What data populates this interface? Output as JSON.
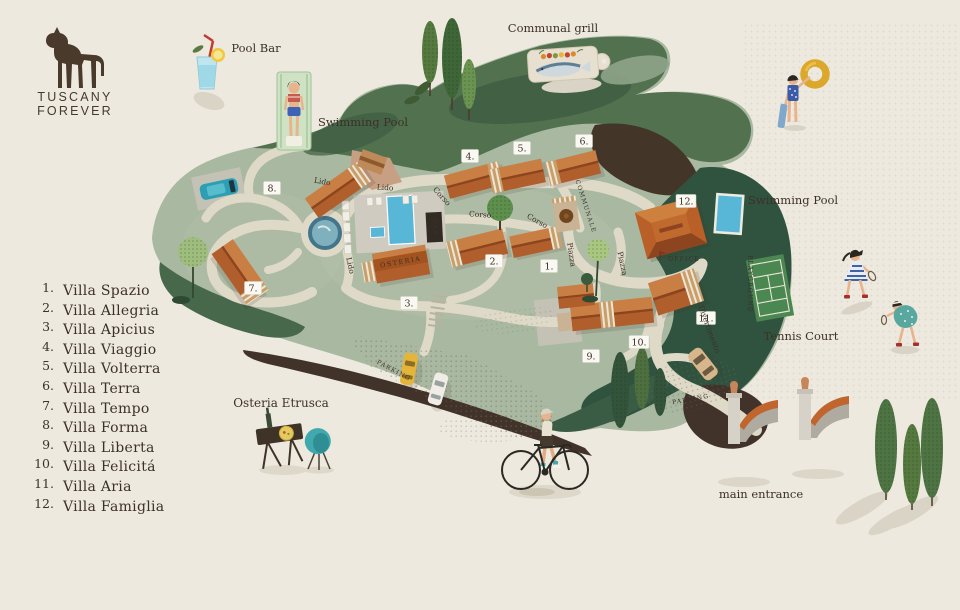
{
  "logo": {
    "line1": "TUSCANY",
    "line2": "FOREVER"
  },
  "legend": {
    "items": [
      {
        "num": "1.",
        "name": "Villa Spazio"
      },
      {
        "num": "2.",
        "name": "Villa Allegria"
      },
      {
        "num": "3.",
        "name": "Villa Apicius"
      },
      {
        "num": "4.",
        "name": "Villa Viaggio"
      },
      {
        "num": "5.",
        "name": "Villa Volterra"
      },
      {
        "num": "6.",
        "name": "Villa Terra"
      },
      {
        "num": "7.",
        "name": "Villa Tempo"
      },
      {
        "num": "8.",
        "name": "Villa Forma"
      },
      {
        "num": "9.",
        "name": "Villa Liberta"
      },
      {
        "num": "10.",
        "name": "Villa Felicitá"
      },
      {
        "num": "11.",
        "name": "Villa Aria"
      },
      {
        "num": "12.",
        "name": "Villa Famiglia"
      }
    ]
  },
  "labels": {
    "pool_bar": "Pool Bar",
    "communal_grill": "Communal grill",
    "swimming_pool_left": "Swimming Pool",
    "swimming_pool_right": "Swimming Pool",
    "tennis_court": "Tennis Court",
    "osteria_etrusca": "Osteria Etrusca",
    "main_entrance": "main entrance"
  },
  "roads": {
    "lido": "Lido",
    "corso": "Corso",
    "communale": "COMMUNALE",
    "piazza": "Piazza",
    "divertimento": "Divertimento",
    "playground": "PLAYGROUND",
    "parking": "PARKING",
    "office": "OFFICE",
    "osteria": "OSTERIA",
    "bar": "BAR"
  },
  "badges": [
    "1.",
    "2.",
    "3.",
    "4.",
    "5.",
    "6.",
    "7.",
    "8.",
    "9.",
    "10.",
    "11.",
    "12."
  ],
  "colors": {
    "background": "#EDE9DE",
    "map_green": "#A9B8A1",
    "forest_green": "#51714F",
    "deep_green": "#30533F",
    "dark_brown": "#443529",
    "road": "#DFD9C8",
    "roof_terracotta": "#B05E2B",
    "pool_blue": "#58B7D6",
    "tennis_green": "#4B8751",
    "ring_yellow": "#DCA82B",
    "car_teal": "#2D9FB4",
    "car_yellow": "#E5B53B"
  }
}
